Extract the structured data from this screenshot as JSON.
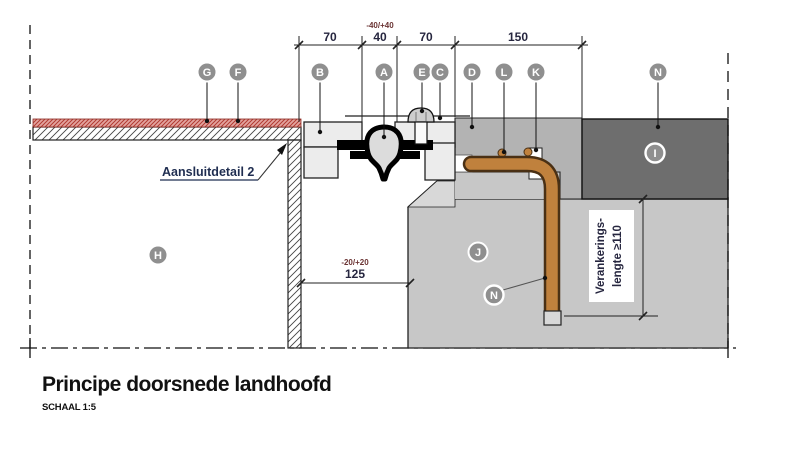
{
  "drawing": {
    "title": "Principe doorsnede landhoofd",
    "scale_note": "SCHAAL 1:5",
    "detail_note": "Aansluitdetail 2",
    "anchor_note_line1": "Verankerings-",
    "anchor_note_line2": "lengte ≥110"
  },
  "dimensions": {
    "seg1": "70",
    "seg2": "40",
    "seg3": "70",
    "seg4": "150",
    "tol_top": "-40/+40",
    "gap": "125",
    "tol_gap": "-20/+20"
  },
  "callouts": {
    "A": "A",
    "B": "B",
    "C": "C",
    "D": "D",
    "E": "E",
    "F": "F",
    "G": "G",
    "H": "H",
    "I": "I",
    "J": "J",
    "K": "K",
    "L": "L",
    "N": "N"
  },
  "colors": {
    "anchor_orange": "#c0813d",
    "anchor_outline": "#4a3014",
    "dark_block": "#6e6e6e",
    "mid_gray": "#b3b3b3",
    "concrete": "#c7c7c7",
    "joint_block": "#ececec",
    "red_layer_stroke": "#8a2a22"
  }
}
